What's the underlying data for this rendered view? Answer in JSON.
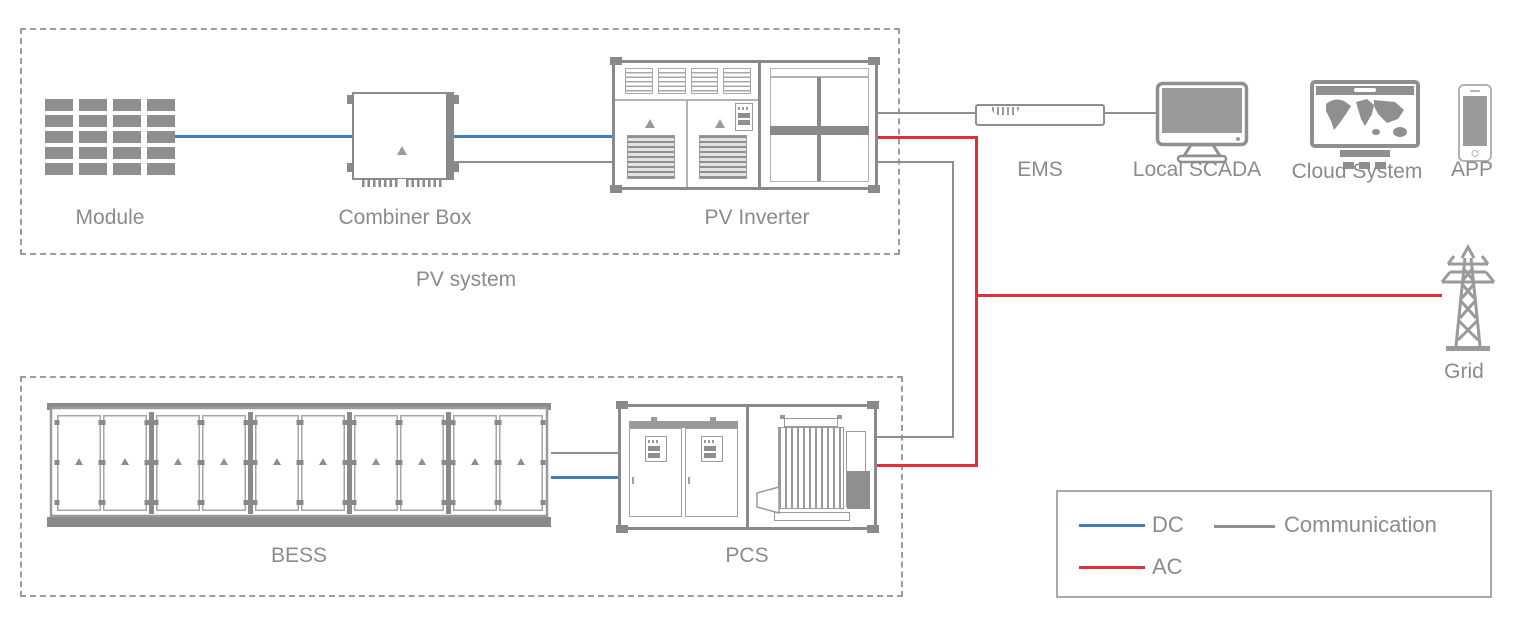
{
  "labels": {
    "module": "Module",
    "combiner_box": "Combiner Box",
    "pv_inverter": "PV Inverter",
    "pv_system": "PV system",
    "ems": "EMS",
    "local_scada": "Local SCADA",
    "cloud_system": "Cloud System",
    "app": "APP",
    "grid": "Grid",
    "bess": "BESS",
    "pcs": "PCS"
  },
  "legend": {
    "dc": {
      "label": "DC",
      "color": "#3f7fbe"
    },
    "ac": {
      "label": "AC",
      "color": "#e0303a"
    },
    "communication": {
      "label": "Communication",
      "color": "#8f8f8f"
    }
  },
  "colors": {
    "dc_line": "#3f7fbe",
    "ac_line": "#e0303a",
    "communication_line": "#8f8f8f",
    "component_outline": "#8a8a8a",
    "component_detail": "#9a9a9a",
    "label_text": "#8b8b8b",
    "group_border": "#9c9c9c",
    "legend_border": "#a8a8a8",
    "screen_fill": "#9a9a9a",
    "module_fill": "#8f8f8f"
  },
  "icons": {
    "solar-module-icon": "grid of gray cells",
    "combiner-box-icon": "box with warning triangle and terminal teeth",
    "pv-inverter-icon": "cabinet with vents, doors and window cross",
    "ems-icon": "rack unit bar",
    "local-scada-icon": "desktop monitor",
    "cloud-system-icon": "monitor with world map",
    "app-icon": "smartphone",
    "grid-icon": "transmission tower",
    "bess-icon": "battery container with doors",
    "pcs-icon": "cabinet with transformer"
  }
}
